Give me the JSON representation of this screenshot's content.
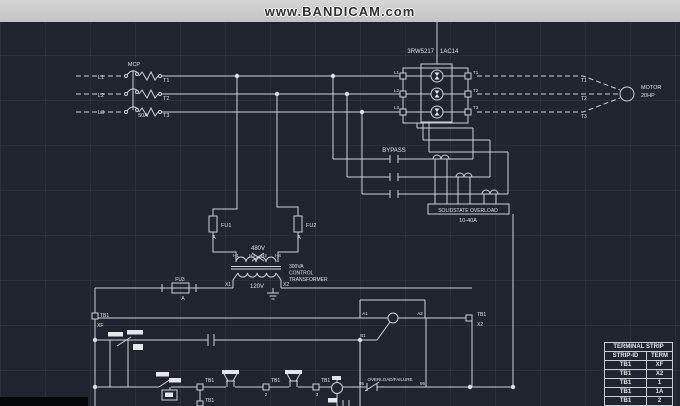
{
  "banner": {
    "text": "www.BANDICAM.com"
  },
  "colors": {
    "background": "#20242e",
    "line": "#ccd1d9",
    "banner_bg": "#cdcdcd",
    "banner_text": "#2e2e2e"
  },
  "power": {
    "breaker": {
      "label": "MCP",
      "rating": "50A",
      "lines_in": [
        "L1",
        "L2",
        "L3"
      ],
      "lines_out": [
        "T1",
        "T2",
        "T3"
      ]
    },
    "starter": {
      "model_left": "3RW5217",
      "model_right": "1AC14",
      "left_terminals": [
        "L1",
        "L2",
        "L3"
      ],
      "right_terminals": [
        "T1",
        "T2",
        "T3"
      ]
    },
    "bypass_label": "BYPASS",
    "overload": {
      "title": "SOLIDSTATE OVERLOAD",
      "range": "10-40A"
    },
    "motor": {
      "name": "MOTOR",
      "hp": "20HP",
      "leads": [
        "T1",
        "T2",
        "T3"
      ]
    }
  },
  "transformer": {
    "fu1": "FU1",
    "fu2": "FU2",
    "fu3": "FU3",
    "fuse_class": "A",
    "primary_voltage": "480V",
    "secondary_voltage": "120V",
    "primary_terminals": [
      "H1",
      "H3",
      "H2",
      "H4"
    ],
    "secondary_terminals": [
      "X1",
      "X2"
    ],
    "rating": [
      "300VA",
      "CONTROL",
      "TRANSFORMER"
    ]
  },
  "control": {
    "overload_contact": {
      "label": "OVERLOAD/FAILURE",
      "left_term": "95",
      "right_term": "96"
    },
    "coil_terminals": [
      "A1",
      "A2",
      "B1"
    ]
  },
  "terminal_strip": {
    "title": "TERMINAL STRIP",
    "columns": [
      "STRIP-ID",
      "TERM"
    ],
    "rows": [
      [
        "TB1",
        "XF"
      ],
      [
        "TB1",
        "X2"
      ],
      [
        "TB1",
        "1"
      ],
      [
        "TB1",
        "1A"
      ],
      [
        "TB1",
        "2"
      ]
    ]
  },
  "labels": [
    {
      "name": "mcp-label",
      "text": "MCP",
      "x": 134,
      "y": 66,
      "fs": 5.5,
      "anchor": "middle"
    },
    {
      "name": "line1-in-label",
      "text": "L1",
      "x": 101,
      "y": 79,
      "fs": 5.5,
      "anchor": "middle"
    },
    {
      "name": "line2-in-label",
      "text": "L2",
      "x": 101,
      "y": 97,
      "fs": 5.5,
      "anchor": "middle"
    },
    {
      "name": "line3-in-label",
      "text": "L3",
      "x": 101,
      "y": 114,
      "fs": 5.5,
      "anchor": "middle"
    },
    {
      "name": "pole1-out-label",
      "text": "T1",
      "x": 163,
      "y": 82,
      "fs": 5.5,
      "anchor": "start"
    },
    {
      "name": "pole2-out-label",
      "text": "T2",
      "x": 163,
      "y": 100,
      "fs": 5.5,
      "anchor": "start"
    },
    {
      "name": "pole3-out-label",
      "text": "T3",
      "x": 163,
      "y": 117,
      "fs": 5.5,
      "anchor": "start"
    },
    {
      "name": "breaker-rating",
      "text": "50A",
      "x": 143,
      "y": 117,
      "fs": 5.5,
      "anchor": "middle"
    },
    {
      "name": "starter-model-left",
      "text": "3RW5217",
      "x": 434,
      "y": 53,
      "fs": 6,
      "anchor": "end"
    },
    {
      "name": "starter-model-right",
      "text": "1AC14",
      "x": 440,
      "y": 53,
      "fs": 6,
      "anchor": "start"
    },
    {
      "name": "starter-l1-label",
      "text": "L1",
      "x": 399,
      "y": 74,
      "fs": 4.5,
      "anchor": "end"
    },
    {
      "name": "starter-l2-label",
      "text": "L2",
      "x": 399,
      "y": 92,
      "fs": 4.5,
      "anchor": "end"
    },
    {
      "name": "starter-l3-label",
      "text": "L3",
      "x": 399,
      "y": 109,
      "fs": 4.5,
      "anchor": "end"
    },
    {
      "name": "starter-t1-label",
      "text": "T1",
      "x": 473,
      "y": 74,
      "fs": 4.5,
      "anchor": "start"
    },
    {
      "name": "starter-t2-label",
      "text": "T2",
      "x": 473,
      "y": 92,
      "fs": 4.5,
      "anchor": "start"
    },
    {
      "name": "starter-t3-label",
      "text": "T3",
      "x": 473,
      "y": 109,
      "fs": 4.5,
      "anchor": "start"
    },
    {
      "name": "motor-t1-label",
      "text": "T1",
      "x": 581,
      "y": 82,
      "fs": 5,
      "anchor": "start"
    },
    {
      "name": "motor-t2-label",
      "text": "T2",
      "x": 581,
      "y": 100,
      "fs": 5,
      "anchor": "start"
    },
    {
      "name": "motor-t3-label",
      "text": "T3",
      "x": 581,
      "y": 118,
      "fs": 5,
      "anchor": "start"
    },
    {
      "name": "motor-name",
      "text": "MOTOR",
      "x": 641,
      "y": 89,
      "fs": 5.5,
      "anchor": "start"
    },
    {
      "name": "motor-hp",
      "text": "20HP",
      "x": 641,
      "y": 97,
      "fs": 5.5,
      "anchor": "start"
    },
    {
      "name": "bypass-label",
      "text": "BYPASS",
      "x": 394,
      "y": 152,
      "fs": 6,
      "anchor": "middle"
    },
    {
      "name": "overload-title",
      "text": "SOLIDSTATE OVERLOAD",
      "x": 468,
      "y": 212,
      "fs": 5,
      "anchor": "middle"
    },
    {
      "name": "overload-range",
      "text": "10-40A",
      "x": 468,
      "y": 222,
      "fs": 5.5,
      "anchor": "middle"
    },
    {
      "name": "fu1-label",
      "text": "FU1",
      "x": 221,
      "y": 227,
      "fs": 5.5,
      "anchor": "start"
    },
    {
      "name": "fu1-class",
      "text": "A",
      "x": 214,
      "y": 239,
      "fs": 5,
      "anchor": "middle"
    },
    {
      "name": "fu2-label",
      "text": "FU2",
      "x": 306,
      "y": 227,
      "fs": 5.5,
      "anchor": "start"
    },
    {
      "name": "fu2-class",
      "text": "A",
      "x": 299,
      "y": 239,
      "fs": 5,
      "anchor": "middle"
    },
    {
      "name": "primary-voltage",
      "text": "480V",
      "x": 258,
      "y": 250,
      "fs": 6,
      "anchor": "middle"
    },
    {
      "name": "h1-label",
      "text": "H1",
      "x": 236,
      "y": 257,
      "fs": 4.5,
      "anchor": "middle"
    },
    {
      "name": "h3-label",
      "text": "H3",
      "x": 252,
      "y": 257,
      "fs": 4.5,
      "anchor": "middle"
    },
    {
      "name": "h2-label",
      "text": "H2",
      "x": 264,
      "y": 257,
      "fs": 4.5,
      "anchor": "middle"
    },
    {
      "name": "h4-label",
      "text": "H4",
      "x": 278,
      "y": 257,
      "fs": 4.5,
      "anchor": "middle"
    },
    {
      "name": "xfmr-rating-1",
      "text": "300VA",
      "x": 289,
      "y": 268,
      "fs": 5,
      "anchor": "start"
    },
    {
      "name": "xfmr-rating-2",
      "text": "CONTROL",
      "x": 289,
      "y": 274.5,
      "fs": 5,
      "anchor": "start"
    },
    {
      "name": "xfmr-rating-3",
      "text": "TRANSFORMER",
      "x": 289,
      "y": 281,
      "fs": 5,
      "anchor": "start"
    },
    {
      "name": "x1-label",
      "text": "X1",
      "x": 228,
      "y": 286,
      "fs": 5,
      "anchor": "middle"
    },
    {
      "name": "secondary-voltage",
      "text": "120V",
      "x": 257,
      "y": 288,
      "fs": 6,
      "anchor": "middle"
    },
    {
      "name": "x2-label",
      "text": "X2",
      "x": 283,
      "y": 286,
      "fs": 5,
      "anchor": "start"
    },
    {
      "name": "fu3-label",
      "text": "FU3",
      "x": 180,
      "y": 281,
      "fs": 5,
      "anchor": "middle"
    },
    {
      "name": "fu3-class",
      "text": "A",
      "x": 183,
      "y": 300,
      "fs": 5,
      "anchor": "middle"
    },
    {
      "name": "tb1-xf-strip",
      "text": "TB1",
      "x": 100,
      "y": 317,
      "fs": 5,
      "anchor": "start"
    },
    {
      "name": "tb1-xf-term",
      "text": "XF",
      "x": 97,
      "y": 327,
      "fs": 5,
      "anchor": "start"
    },
    {
      "name": "a1-label",
      "text": "A1",
      "x": 365,
      "y": 315,
      "fs": 4.5,
      "anchor": "middle"
    },
    {
      "name": "a2-label",
      "text": "A2",
      "x": 420,
      "y": 315,
      "fs": 4.5,
      "anchor": "middle"
    },
    {
      "name": "b1-label",
      "text": "B1",
      "x": 363,
      "y": 337,
      "fs": 4.5,
      "anchor": "middle"
    },
    {
      "name": "tb1-x2-strip",
      "text": "TB1",
      "x": 477,
      "y": 316,
      "fs": 5,
      "anchor": "start"
    },
    {
      "name": "tb1-x2-term",
      "text": "X2",
      "x": 477,
      "y": 326,
      "fs": 5,
      "anchor": "start"
    },
    {
      "name": "tb1-1-strip",
      "text": "TB1",
      "x": 205,
      "y": 382,
      "fs": 5,
      "anchor": "start"
    },
    {
      "name": "tb1-1a-strip",
      "text": "TB1",
      "x": 205,
      "y": 402,
      "fs": 5,
      "anchor": "start"
    },
    {
      "name": "tb1-2-strip",
      "text": "TB1",
      "x": 271,
      "y": 382,
      "fs": 5,
      "anchor": "start"
    },
    {
      "name": "tb1-2-term",
      "text": "2",
      "x": 266,
      "y": 396,
      "fs": 4.5,
      "anchor": "middle"
    },
    {
      "name": "tb1-3-strip",
      "text": "TB1",
      "x": 321,
      "y": 382,
      "fs": 5,
      "anchor": "start"
    },
    {
      "name": "tb1-3-term",
      "text": "3",
      "x": 317,
      "y": 396,
      "fs": 4.5,
      "anchor": "middle"
    },
    {
      "name": "overload-contact-label",
      "text": "OVERLOAD/FAILURE",
      "x": 390,
      "y": 381,
      "fs": 4.5,
      "anchor": "middle"
    },
    {
      "name": "overload-contact-95",
      "text": "95",
      "x": 364,
      "y": 385,
      "fs": 4.5,
      "anchor": "end"
    },
    {
      "name": "overload-contact-96",
      "text": "96",
      "x": 420,
      "y": 385,
      "fs": 4.5,
      "anchor": "start"
    }
  ]
}
